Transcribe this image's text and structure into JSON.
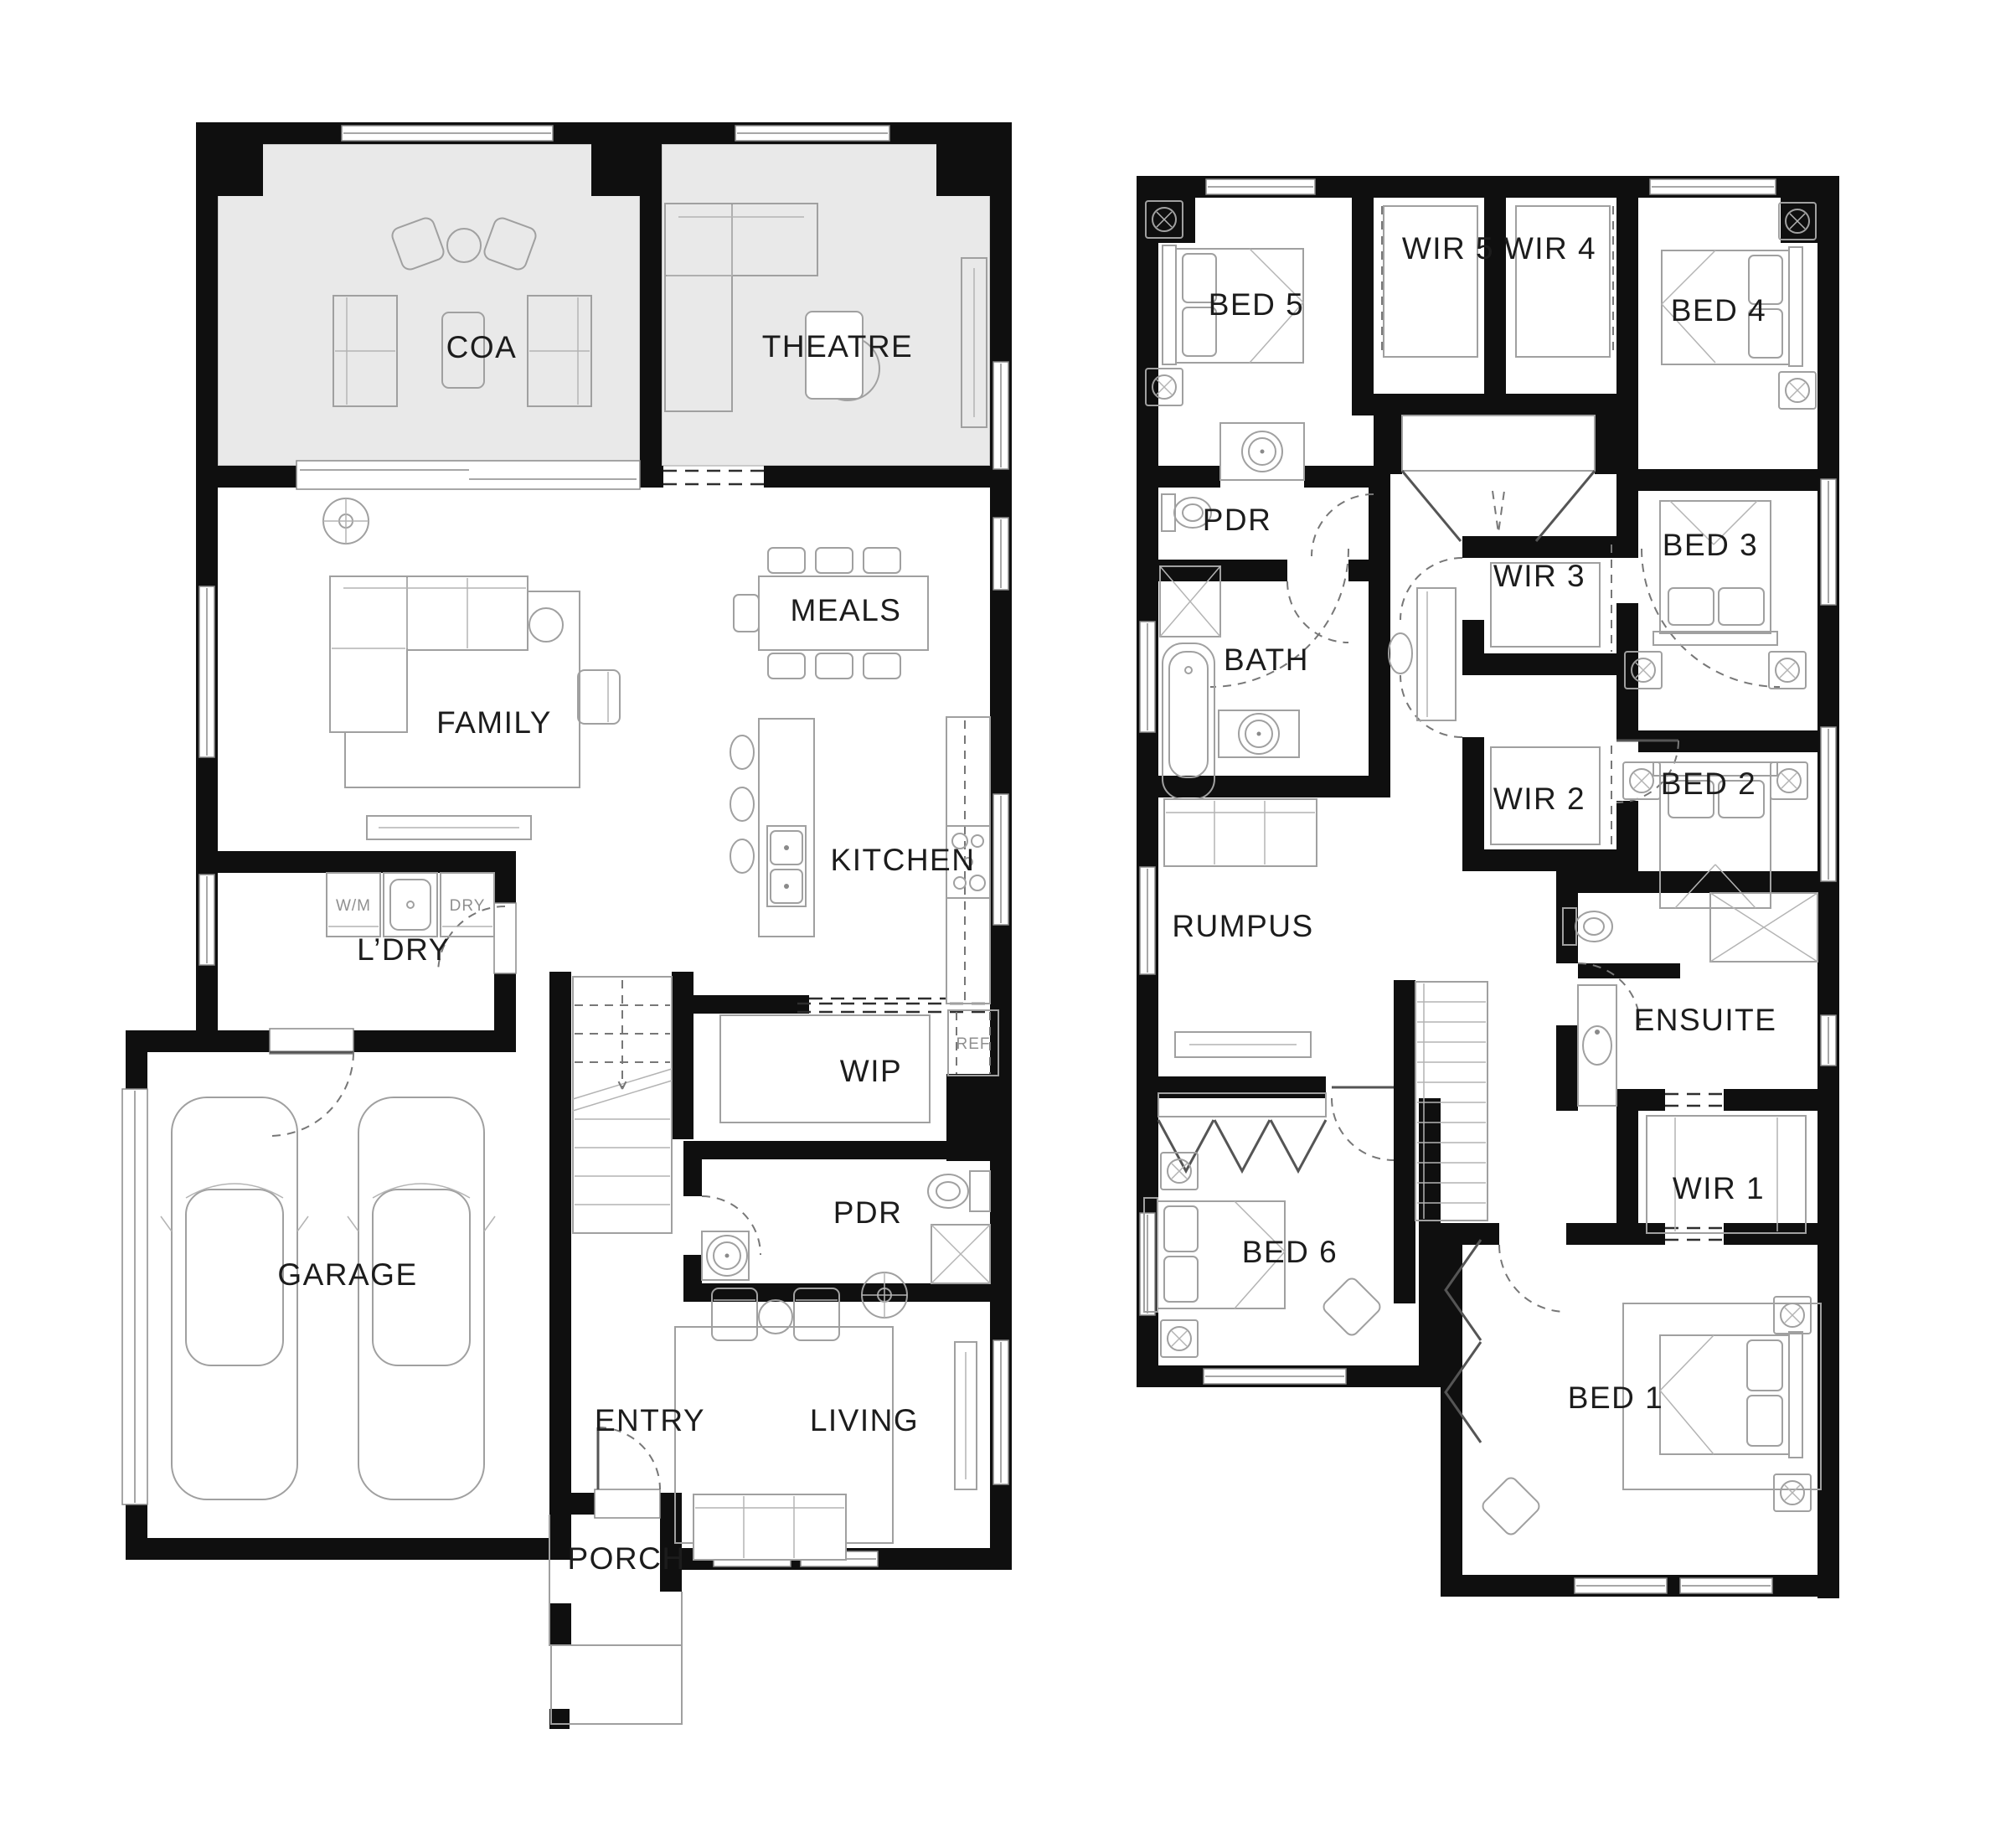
{
  "document_type": "architectural floor plan, two storeys",
  "colors": {
    "background": "#ffffff",
    "walls": "#0f0f0f",
    "highlight_room_fill": "#e9e9e9",
    "furniture_line": "#a0a0a0",
    "label_text": "#1c1c1c",
    "small_label_text": "#8f8f8f"
  },
  "ground_floor": {
    "rooms": [
      {
        "label": "COA"
      },
      {
        "label": "THEATRE"
      },
      {
        "label": "MEALS"
      },
      {
        "label": "FAMILY"
      },
      {
        "label": "KITCHEN"
      },
      {
        "label": "L’DRY"
      },
      {
        "label": "WIP"
      },
      {
        "label": "PDR"
      },
      {
        "label": "GARAGE"
      },
      {
        "label": "ENTRY"
      },
      {
        "label": "LIVING"
      },
      {
        "label": "PORCH"
      }
    ],
    "appliance_labels": [
      {
        "label": "W/M"
      },
      {
        "label": "DRY"
      },
      {
        "label": "REF"
      }
    ]
  },
  "upper_floor": {
    "rooms": [
      {
        "label": "BED 5"
      },
      {
        "label": "WIR 5"
      },
      {
        "label": "WIR 4"
      },
      {
        "label": "BED 4"
      },
      {
        "label": "PDR"
      },
      {
        "label": "BATH"
      },
      {
        "label": "WIR 3"
      },
      {
        "label": "BED 3"
      },
      {
        "label": "WIR 2"
      },
      {
        "label": "BED 2"
      },
      {
        "label": "RUMPUS"
      },
      {
        "label": "ENSUITE"
      },
      {
        "label": "WIR 1"
      },
      {
        "label": "BED 6"
      },
      {
        "label": "BED 1"
      }
    ]
  }
}
